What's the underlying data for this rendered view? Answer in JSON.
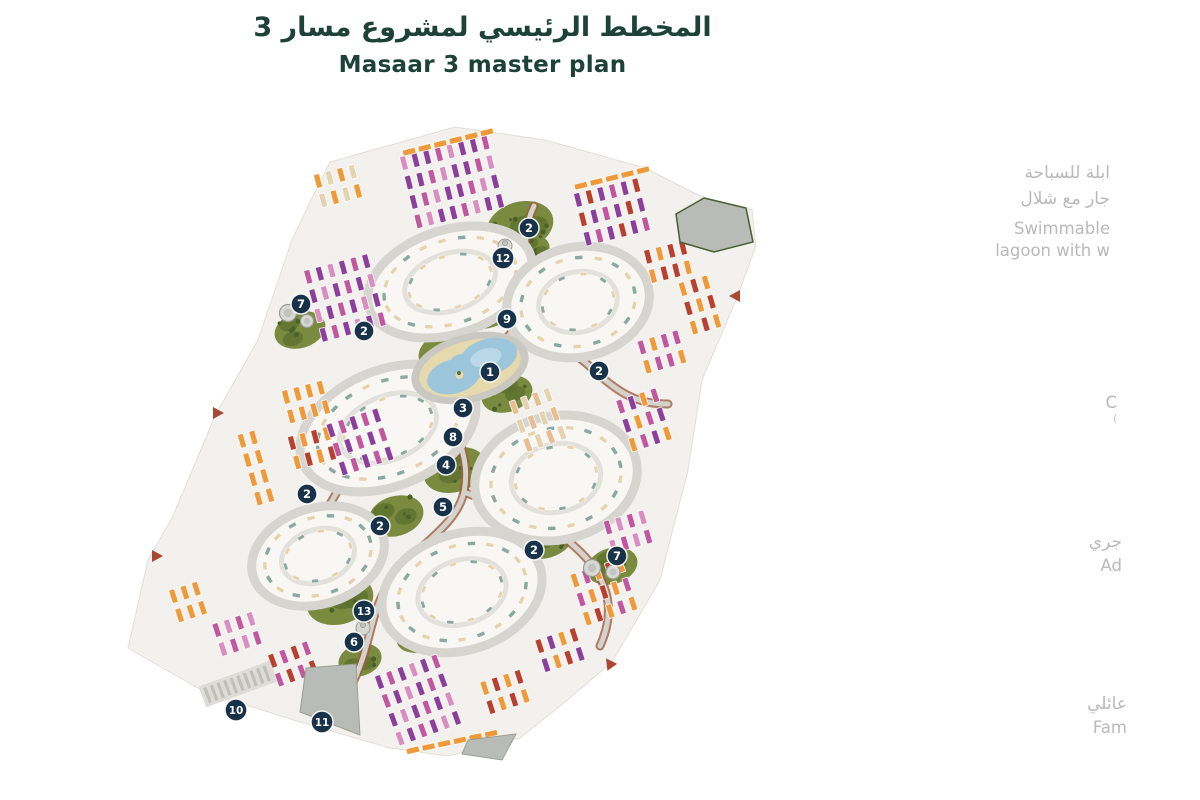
{
  "title": {
    "arabic": "المخطط الرئيسي لمشروع مسار 3",
    "english": "Masaar 3 master plan"
  },
  "legend_fragments": [
    {
      "lines": [
        "ابلة للسباحة",
        "جار مع شلال",
        "Swimmable",
        "lagoon with w"
      ]
    },
    {
      "lines": [
        "C",
        "("
      ]
    },
    {
      "lines": [
        "جري",
        "Ad"
      ]
    },
    {
      "lines": [
        "عائلي",
        "Fam"
      ]
    }
  ],
  "markers": [
    {
      "label": "2",
      "x": 529,
      "y": 228
    },
    {
      "label": "12",
      "x": 503,
      "y": 258
    },
    {
      "label": "7",
      "x": 301,
      "y": 304
    },
    {
      "label": "9",
      "x": 507,
      "y": 319
    },
    {
      "label": "2",
      "x": 364,
      "y": 331
    },
    {
      "label": "1",
      "x": 490,
      "y": 372
    },
    {
      "label": "2",
      "x": 599,
      "y": 371
    },
    {
      "label": "3",
      "x": 463,
      "y": 408
    },
    {
      "label": "8",
      "x": 453,
      "y": 437
    },
    {
      "label": "4",
      "x": 446,
      "y": 465
    },
    {
      "label": "2",
      "x": 307,
      "y": 494
    },
    {
      "label": "5",
      "x": 443,
      "y": 507
    },
    {
      "label": "2",
      "x": 380,
      "y": 526
    },
    {
      "label": "2",
      "x": 534,
      "y": 550
    },
    {
      "label": "7",
      "x": 617,
      "y": 556
    },
    {
      "label": "13",
      "x": 364,
      "y": 611
    },
    {
      "label": "6",
      "x": 354,
      "y": 642
    },
    {
      "label": "10",
      "x": 236,
      "y": 710
    },
    {
      "label": "11",
      "x": 322,
      "y": 722
    }
  ],
  "palette": {
    "title_green": "#1d4237",
    "legend_gray": "#b9b9b9",
    "badge": "#18324a",
    "site": "#f2f1ed",
    "road": "#d6d5d0",
    "road_edge": "#a05c3f",
    "green_base": "#7a8a3e",
    "green_dark": "#5c6f2d",
    "tree": "#49602a",
    "water": "#9cc6dc",
    "water_light": "#c2dcea",
    "sand": "#e7d9ae",
    "gray_plot": "#b9bbb7",
    "gate_red": "#a84a33",
    "orange": "#ef9a3a",
    "red": "#b8402e",
    "magenta": "#c0579f",
    "purple": "#8b3f9b",
    "pink": "#d98ec0",
    "peach": "#e9bd92",
    "teal": "#8ba8a0",
    "cream": "#e4d3ae"
  }
}
